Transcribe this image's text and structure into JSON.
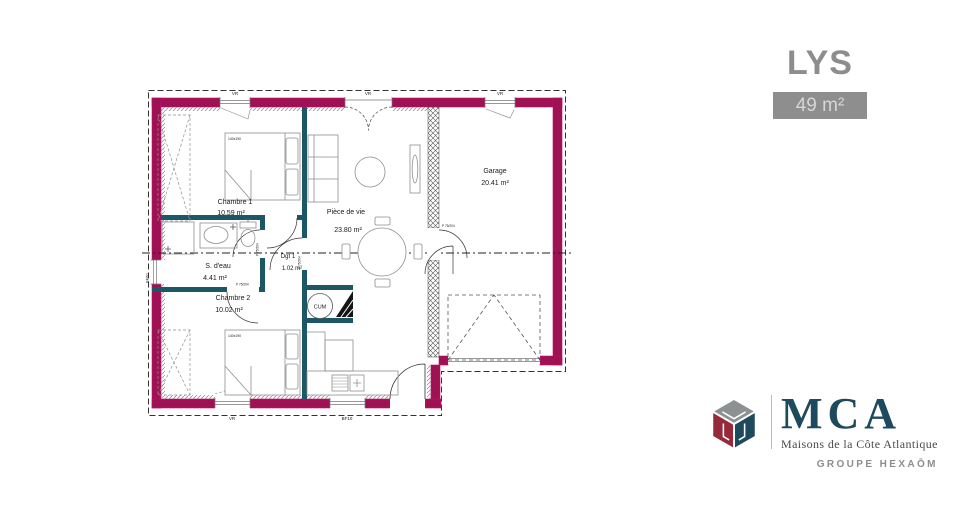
{
  "header": {
    "plan_name": "LYS",
    "area_badge": "49 m²"
  },
  "plan": {
    "rooms": {
      "chambre1": {
        "name": "Chambre 1",
        "area": "10.59 m²"
      },
      "piece_de_vie": {
        "name": "Pièce de vie",
        "area": "23.80 m²"
      },
      "garage": {
        "name": "Garage",
        "area": "20.41 m²"
      },
      "s_deau": {
        "name": "S. d'eau",
        "area": "4.41 m²"
      },
      "chambre2": {
        "name": "Chambre 2",
        "area": "10.02 m²"
      },
      "degagement": {
        "name": "Dgt 1",
        "area": "1.02 m²"
      }
    },
    "labels": {
      "water_heater": "CUM",
      "bed1_size": "140x190",
      "bed2_size": "140x190",
      "door": "P 75/204"
    },
    "windows": {
      "top_left": "VR",
      "top_center": "VR",
      "garage_top": "VR",
      "bottom_left": "VR",
      "bottom_center": "BF10",
      "left_side": "BF60"
    },
    "colors": {
      "exterior_wall": "#9E1152",
      "exterior_wall_edge": "#C90C72",
      "interior_wall": "#1C5766"
    }
  },
  "logo": {
    "brand": "MCA",
    "tagline": "Maisons de la Côte Atlantique",
    "group": "GROUPE HEXAŌM"
  }
}
